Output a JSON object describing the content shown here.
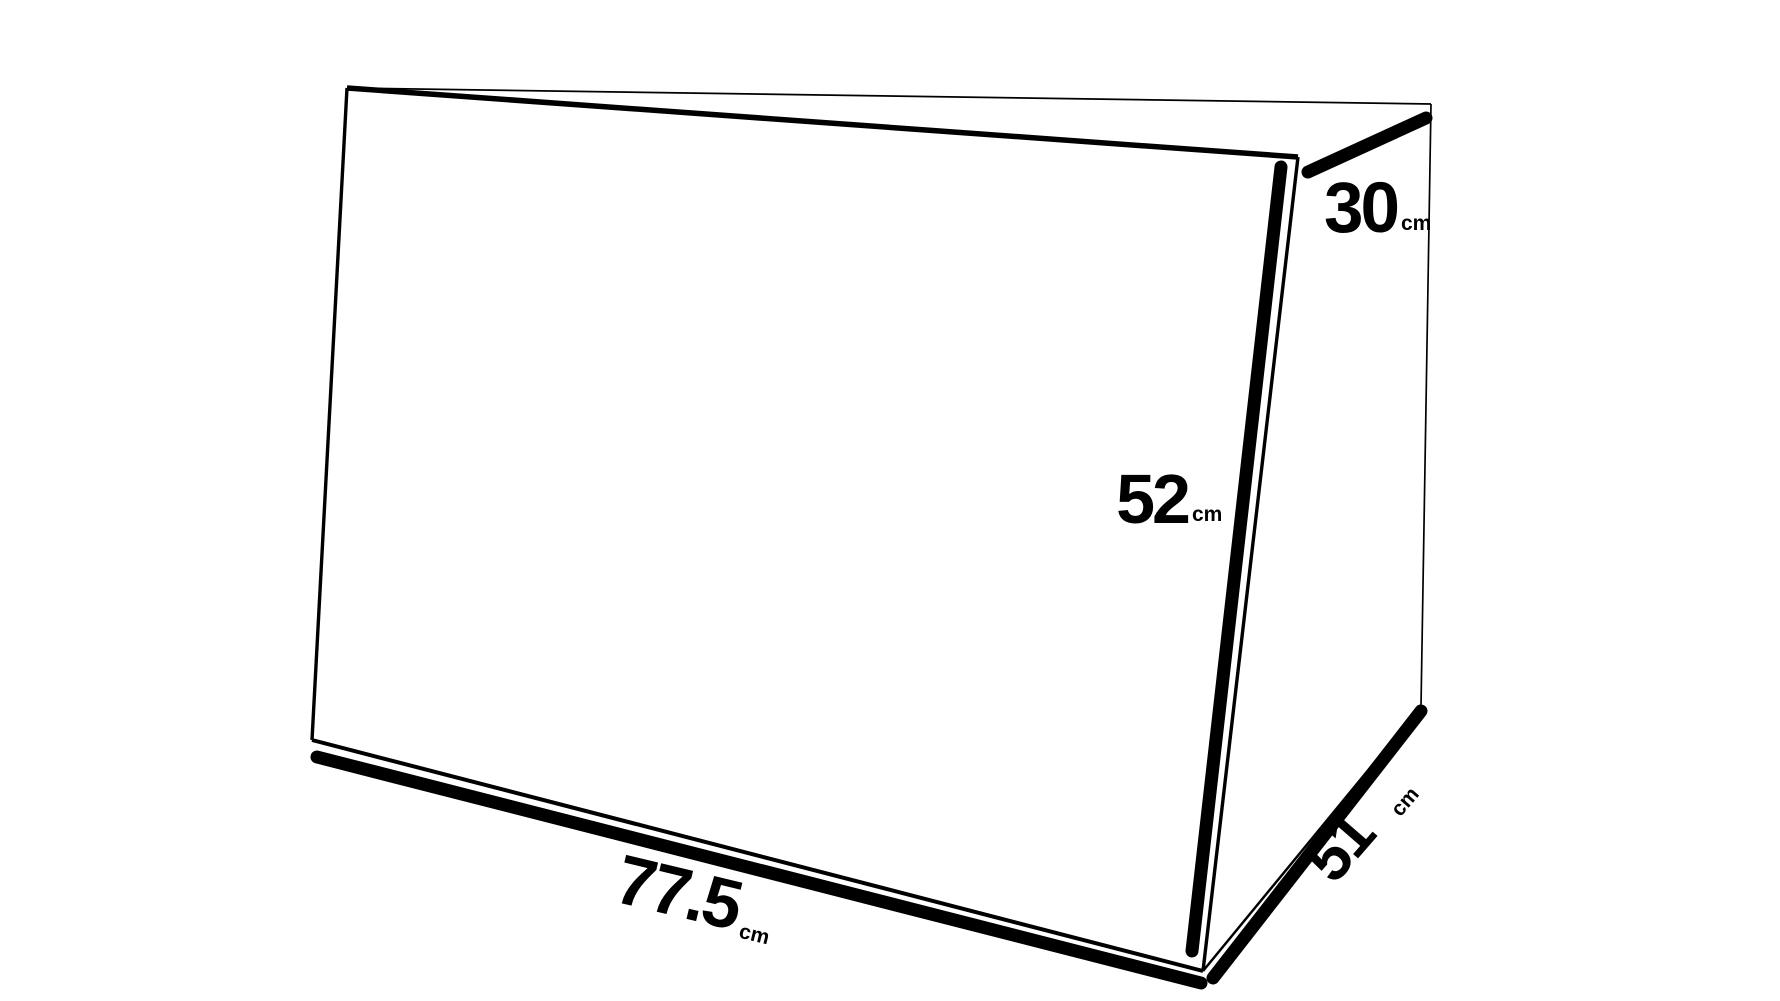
{
  "colors": {
    "background": "#ffffff",
    "ink": "#000000"
  },
  "diagram": {
    "type": "box-dimension-drawing",
    "unit": "cm",
    "dimensions": {
      "width": {
        "value": "77.5",
        "unit": "cm"
      },
      "height": {
        "value": "52",
        "unit": "cm"
      },
      "top_depth": {
        "value": "30",
        "unit": "cm"
      },
      "depth": {
        "value": "51",
        "unit": "cm"
      }
    }
  }
}
